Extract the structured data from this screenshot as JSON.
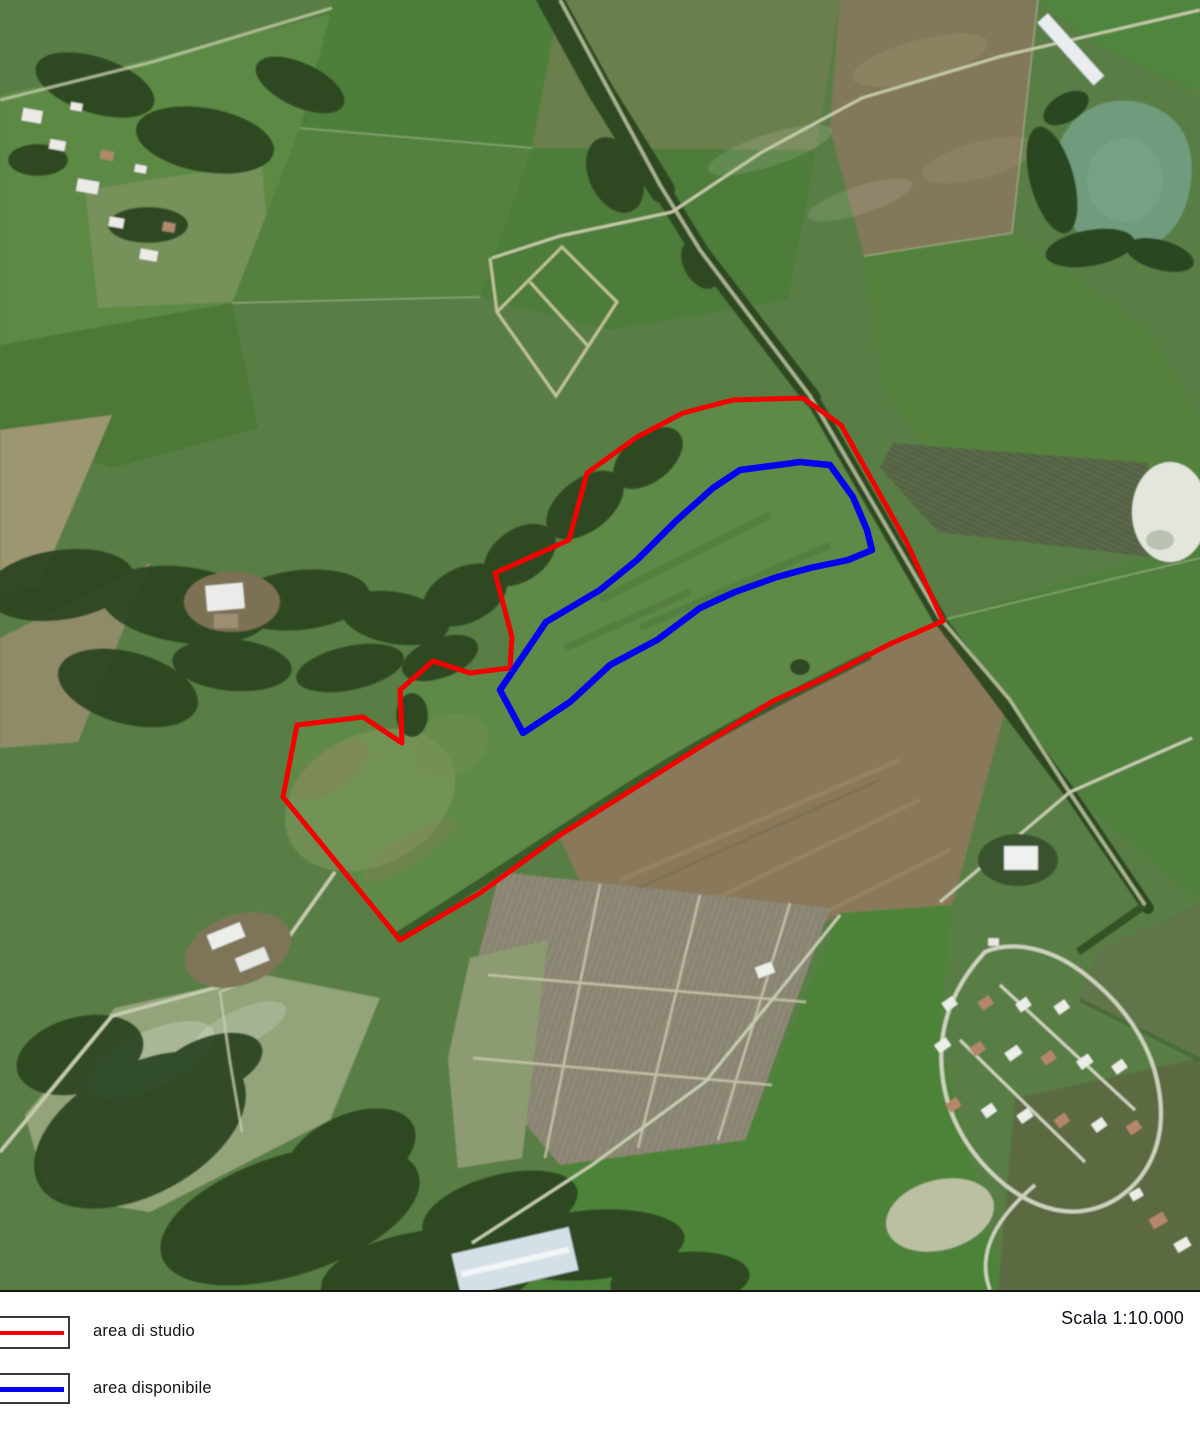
{
  "map": {
    "type": "satellite-orthophoto",
    "scale_label": "Scala 1:10.000",
    "overlays": [
      {
        "name": "area di studio",
        "color": "#f50000",
        "stroke_width": 5,
        "points": "803,398 841,425 906,541 943,621 890,644 820,680 773,701 703,745 627,793 560,835 480,893 400,940 283,797 297,725 363,717 402,743 400,690 433,661 470,673 510,668 512,637 495,573 569,540 587,473 637,437 683,413 733,400"
      },
      {
        "name": "area disponibile",
        "color": "#0404ee",
        "stroke_width": 6.5,
        "points": "500,690 546,622 600,590 637,560 677,520 713,488 740,470 800,462 830,465 853,497 867,530 872,550 848,560 810,568 777,577 735,592 700,608 657,640 610,665 570,702 523,733"
      }
    ]
  },
  "legend": {
    "items": [
      {
        "label": "area di studio",
        "color": "#f50000"
      },
      {
        "label": "area disponibile",
        "color": "#0404ee"
      }
    ]
  }
}
